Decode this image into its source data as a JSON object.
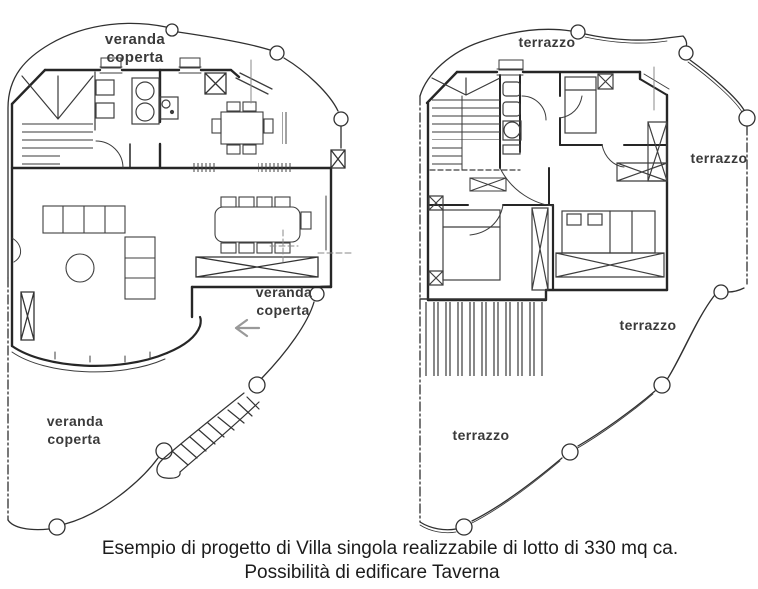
{
  "document": {
    "type": "scanned architectural floor plan drawing",
    "background_color": "#ffffff",
    "ink_color": "#262626",
    "boundary_color": "#303030",
    "label_color": "#3a3a3a",
    "caption_color": "#1c1c1c",
    "arrow_color": "#999999"
  },
  "ground_floor_plan": {
    "labels": {
      "veranda_top": {
        "line1": "veranda",
        "line2": "coperta"
      },
      "veranda_entrance": {
        "line1": "veranda",
        "line2": "coperta"
      },
      "veranda_bottom": {
        "line1": "veranda",
        "line2": "coperta"
      }
    }
  },
  "upper_floor_plan": {
    "labels": {
      "terrazzo_top": "terrazzo",
      "terrazzo_right": "terrazzo",
      "terrazzo_middle": "terrazzo",
      "terrazzo_bottom": "terrazzo"
    }
  },
  "caption": {
    "line1": "Esempio di progetto di Villa singola realizzabile di lotto di 330 mq ca.",
    "line2": "Possibilità di edificare Taverna"
  }
}
